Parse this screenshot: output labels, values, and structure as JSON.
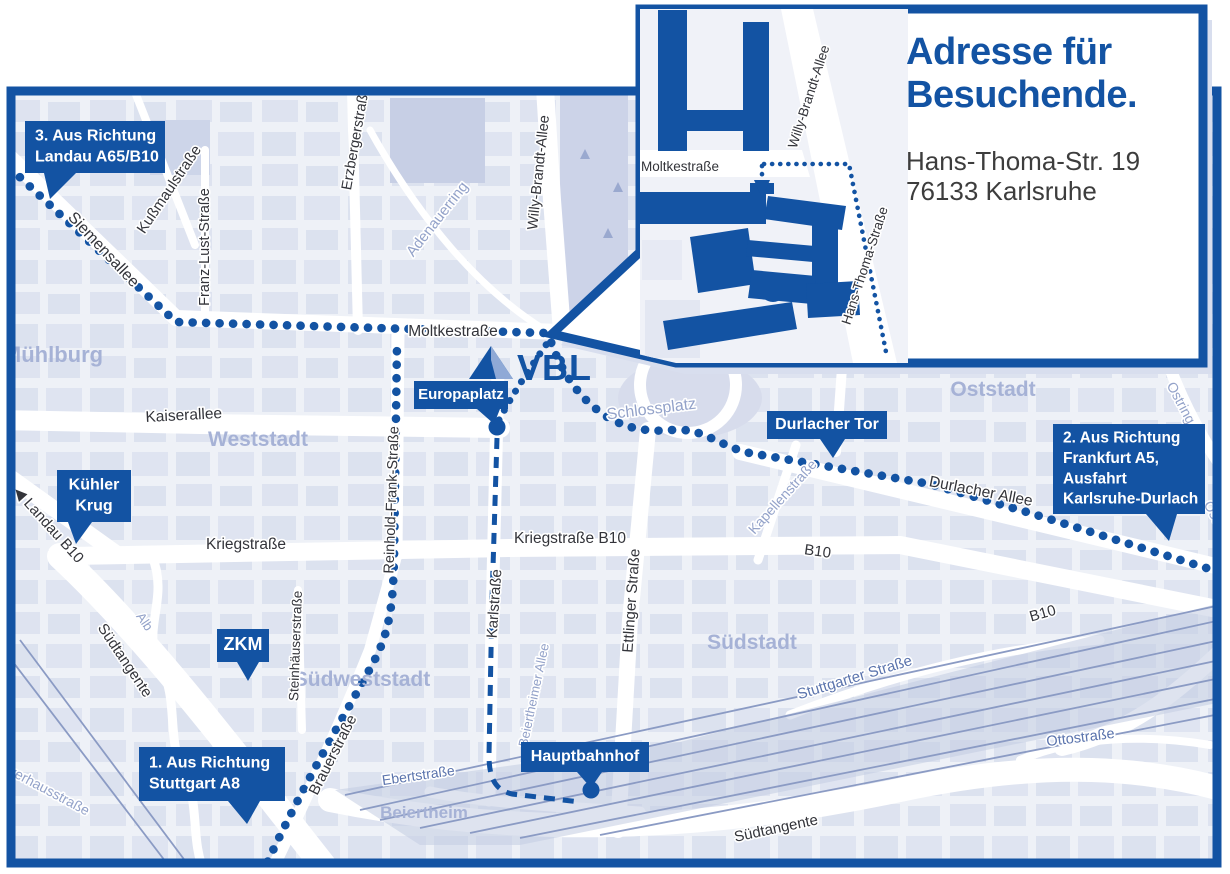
{
  "colors": {
    "primary_blue": "#1353a3",
    "map_background": "#eef1f7",
    "city_block": "#d9dfee",
    "park": "#ccd3e8",
    "district_label": "#a6b2d6",
    "street_label_dark": "#33343a",
    "street_label_light": "#93a2c9",
    "river": "#c2cbe6",
    "railway": "#8b9bc4",
    "address_text": "#3d3d3d"
  },
  "inset": {
    "title_line1": "Adresse für",
    "title_line2": "Besuchende.",
    "address_line1": "Hans-Thoma-Str. 19",
    "address_line2": "76133 Karlsruhe",
    "streets": [
      {
        "t": "Moltkestraße",
        "x": 680,
        "y": 171,
        "r": 0,
        "s": 13.5
      },
      {
        "t": "Willy-Brandt-Allee",
        "x": 813,
        "y": 98,
        "r": -72,
        "s": 13.5
      },
      {
        "t": "Hans-Thoma-Straße",
        "x": 869,
        "y": 267,
        "r": -72,
        "s": 13.5
      }
    ]
  },
  "map": {
    "vbl_logo_text": "VBL",
    "districts": [
      {
        "t": "Mühlburg",
        "x": 53,
        "y": 362,
        "s": 22
      },
      {
        "t": "Weststadt",
        "x": 258,
        "y": 446,
        "s": 21
      },
      {
        "t": "Südweststadt",
        "x": 362,
        "y": 686,
        "s": 21
      },
      {
        "t": "Südstadt",
        "x": 752,
        "y": 649,
        "s": 21
      },
      {
        "t": "Oststadt",
        "x": 993,
        "y": 396,
        "s": 21
      },
      {
        "t": "Beiertheim",
        "x": 424,
        "y": 818,
        "s": 17
      }
    ],
    "street_labels": [
      {
        "t": "Siemensallee",
        "x": 100,
        "y": 253,
        "r": 47,
        "s": 16,
        "c": "dark"
      },
      {
        "t": "Kußmaulstraße",
        "x": 173,
        "y": 192,
        "r": -56,
        "s": 15,
        "c": "dark"
      },
      {
        "t": "Franz-Lust-Straße",
        "x": 209,
        "y": 247,
        "r": -90,
        "s": 14.5,
        "c": "dark"
      },
      {
        "t": "Erzbergerstraße",
        "x": 360,
        "y": 139,
        "r": -80,
        "s": 14.5,
        "c": "dark"
      },
      {
        "t": "Adenauerring",
        "x": 441,
        "y": 222,
        "r": -52,
        "s": 15,
        "c": "light"
      },
      {
        "t": "Willy-Brandt-Allee",
        "x": 543,
        "y": 173,
        "r": -84,
        "s": 14.5,
        "c": "dark"
      },
      {
        "t": "Moltkestraße",
        "x": 453,
        "y": 336,
        "r": 0,
        "s": 15.5,
        "c": "dark"
      },
      {
        "t": "Kaiserallee",
        "x": 184,
        "y": 420,
        "r": -3,
        "s": 15.5,
        "c": "dark"
      },
      {
        "t": "Reinhold-Frank-Straße",
        "x": 396,
        "y": 500,
        "r": -88,
        "s": 14.5,
        "c": "dark"
      },
      {
        "t": "Kriegstraße",
        "x": 246,
        "y": 549,
        "r": 0,
        "s": 15.5,
        "c": "dark"
      },
      {
        "t": "Kriegstraße B10",
        "x": 570,
        "y": 543,
        "r": 0,
        "s": 15.5,
        "c": "dark"
      },
      {
        "t": "B10",
        "x": 817,
        "y": 556,
        "r": 8,
        "s": 15,
        "c": "dark"
      },
      {
        "t": "B10",
        "x": 1044,
        "y": 618,
        "r": -16,
        "s": 15,
        "c": "dark"
      },
      {
        "t": "Durlacher Allee",
        "x": 980,
        "y": 496,
        "r": 11,
        "s": 15.5,
        "c": "dark"
      },
      {
        "t": "Kapellenstraße",
        "x": 786,
        "y": 500,
        "r": -48,
        "s": 14,
        "c": "light"
      },
      {
        "t": "Ostring",
        "x": 1177,
        "y": 405,
        "r": 62,
        "s": 14,
        "c": "light"
      },
      {
        "t": "Ostring",
        "x": 1214,
        "y": 524,
        "r": 62,
        "s": 14,
        "c": "light"
      },
      {
        "t": "Schlossplatz",
        "x": 652,
        "y": 414,
        "r": -7,
        "s": 16,
        "c": "light"
      },
      {
        "t": "Stuttgarter Straße",
        "x": 856,
        "y": 682,
        "r": -17,
        "s": 15,
        "c": "med"
      },
      {
        "t": "Ottostraße",
        "x": 1081,
        "y": 742,
        "r": -7,
        "s": 14.5,
        "c": "med"
      },
      {
        "t": "Südtangente",
        "x": 121,
        "y": 663,
        "r": 56,
        "s": 15,
        "c": "dark"
      },
      {
        "t": "Südtangente",
        "x": 777,
        "y": 833,
        "r": -12,
        "s": 15,
        "c": "dark"
      },
      {
        "t": "◀ Landau B10",
        "x": 45,
        "y": 528,
        "r": 48,
        "s": 15,
        "c": "dark"
      },
      {
        "t": "Brauerstraße",
        "x": 337,
        "y": 757,
        "r": -63,
        "s": 15,
        "c": "dark"
      },
      {
        "t": "Karlstraße",
        "x": 499,
        "y": 604,
        "r": -86,
        "s": 15,
        "c": "dark"
      },
      {
        "t": "Ettlinger Straße",
        "x": 636,
        "y": 601,
        "r": -86,
        "s": 15,
        "c": "dark"
      },
      {
        "t": "Steinhäuserstraße",
        "x": 300,
        "y": 646,
        "r": -88,
        "s": 13.5,
        "c": "dark"
      },
      {
        "t": "Ebertstraße",
        "x": 419,
        "y": 780,
        "r": -8,
        "s": 14,
        "c": "med"
      },
      {
        "t": "Beiertheimer Allee",
        "x": 538,
        "y": 696,
        "r": -78,
        "s": 13,
        "c": "light"
      },
      {
        "t": "Alb",
        "x": 141,
        "y": 624,
        "r": 56,
        "s": 13,
        "c": "light"
      },
      {
        "t": "Pulverhausstraße",
        "x": 38,
        "y": 790,
        "r": 28,
        "s": 14,
        "c": "light"
      }
    ],
    "callouts": [
      {
        "name": "landau-a65-b10",
        "box": [
          25,
          121,
          140,
          52
        ],
        "tail": "44,173 76,173 50,199",
        "lines": [
          "3. Aus Richtung",
          "Landau A65/B10"
        ],
        "align": "left",
        "fs": 16
      },
      {
        "name": "kuehler-krug",
        "box": [
          57,
          470,
          74,
          52
        ],
        "tail": "68,522 92,522 76,544",
        "lines": [
          "Kühler",
          "Krug"
        ],
        "align": "center",
        "fs": 16
      },
      {
        "name": "zkm",
        "box": [
          217,
          629,
          52,
          33
        ],
        "tail": "237,662 259,662 248,681",
        "lines": [
          "ZKM"
        ],
        "align": "center",
        "fs": 18
      },
      {
        "name": "stuttgart-a8",
        "box": [
          139,
          747,
          146,
          54
        ],
        "tail": "228,801 260,801 247,824",
        "lines": [
          "1. Aus Richtung",
          "Stuttgart A8"
        ],
        "align": "left",
        "fs": 16
      },
      {
        "name": "europaplatz",
        "box": [
          414,
          381,
          94,
          28
        ],
        "tail": "477,409 500,409 494,424",
        "lines": [
          "Europaplatz"
        ],
        "align": "center",
        "fs": 15
      },
      {
        "name": "durlacher-tor",
        "box": [
          767,
          411,
          120,
          28
        ],
        "tail": "820,439 845,439 833,458",
        "lines": [
          "Durlacher Tor"
        ],
        "align": "center",
        "fs": 16
      },
      {
        "name": "hauptbahnhof",
        "box": [
          521,
          742,
          128,
          30
        ],
        "tail": "577,772 602,772 591,788",
        "lines": [
          "Hauptbahnhof"
        ],
        "align": "center",
        "fs": 16
      },
      {
        "name": "frankfurt-a5",
        "box": [
          1053,
          424,
          152,
          90
        ],
        "tail": "1146,514 1177,514 1169,541",
        "lines": [
          "2. Aus Richtung",
          "Frankfurt A5,",
          "Ausfahrt",
          "Karlsruhe-Durlach"
        ],
        "align": "left",
        "fs": 15.5
      }
    ],
    "markers": [
      {
        "name": "europaplatz-stop",
        "x": 497,
        "y": 427
      },
      {
        "name": "hauptbahnhof-stop",
        "x": 591,
        "y": 790
      }
    ]
  }
}
